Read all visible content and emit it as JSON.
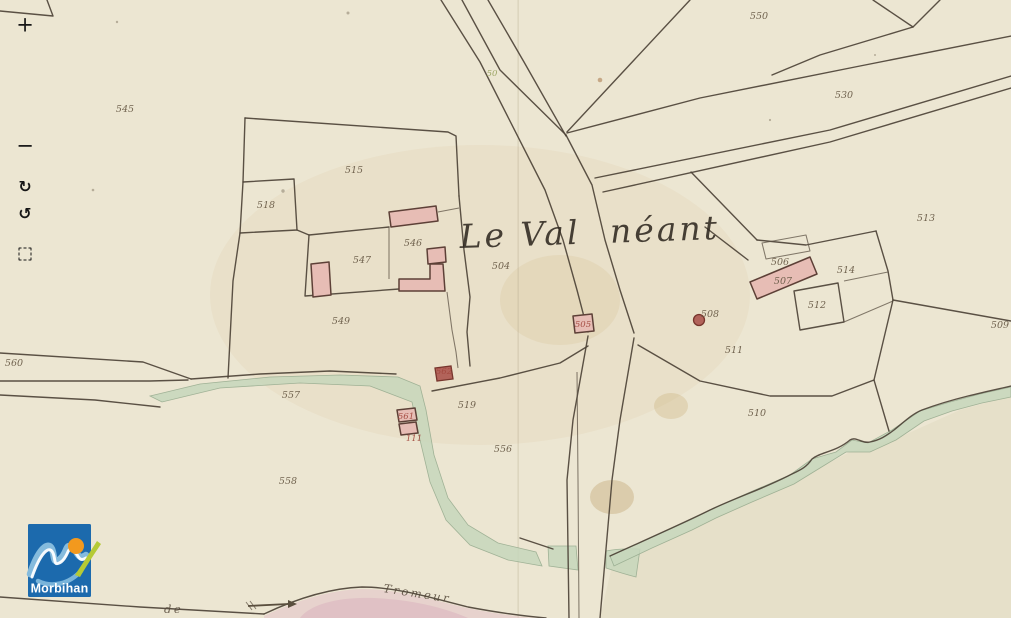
{
  "viewer": {
    "toolbar": {
      "zoom_in": "+",
      "zoom_out": "−",
      "rotate_cw": "↻",
      "rotate_ccw": "↺"
    },
    "logo": {
      "text": "Morbihan"
    }
  },
  "map": {
    "title": {
      "part1": "Le Val",
      "part2": "néant"
    },
    "bottom_text": {
      "de": "de",
      "tromeur": "Tromeur"
    },
    "parcel_labels": [
      {
        "n": "545",
        "x": 125,
        "y": 112
      },
      {
        "n": "515",
        "x": 354,
        "y": 173
      },
      {
        "n": "518",
        "x": 266,
        "y": 208
      },
      {
        "n": "546",
        "x": 413,
        "y": 246
      },
      {
        "n": "547",
        "x": 362,
        "y": 263
      },
      {
        "n": "549",
        "x": 341,
        "y": 324
      },
      {
        "n": "504",
        "x": 501,
        "y": 269
      },
      {
        "n": "50",
        "x": 492,
        "y": 76,
        "color": "green"
      },
      {
        "n": "550",
        "x": 759,
        "y": 19
      },
      {
        "n": "530",
        "x": 844,
        "y": 98
      },
      {
        "n": "513",
        "x": 926,
        "y": 221
      },
      {
        "n": "506",
        "x": 780,
        "y": 265
      },
      {
        "n": "507",
        "x": 783,
        "y": 284
      },
      {
        "n": "514",
        "x": 846,
        "y": 273
      },
      {
        "n": "512",
        "x": 817,
        "y": 308
      },
      {
        "n": "508",
        "x": 710,
        "y": 317
      },
      {
        "n": "511",
        "x": 734,
        "y": 353
      },
      {
        "n": "509",
        "x": 1000,
        "y": 328
      },
      {
        "n": "510",
        "x": 757,
        "y": 416
      },
      {
        "n": "505",
        "x": 583,
        "y": 327,
        "color": "red"
      },
      {
        "n": "562",
        "x": 444,
        "y": 374,
        "color": "red"
      },
      {
        "n": "561",
        "x": 406,
        "y": 419,
        "color": "red"
      },
      {
        "n": "111",
        "x": 414,
        "y": 441,
        "color": "red"
      },
      {
        "n": "519",
        "x": 467,
        "y": 408
      },
      {
        "n": "556",
        "x": 503,
        "y": 452
      },
      {
        "n": "557",
        "x": 291,
        "y": 398
      },
      {
        "n": "558",
        "x": 288,
        "y": 484
      },
      {
        "n": "560",
        "x": 14,
        "y": 366
      }
    ],
    "colors": {
      "paper": "#ece6d2",
      "ink": "#4d4337",
      "building_pink": "#e7bdb5",
      "building_red": "#b2635a",
      "water_green": "#c7d7bc",
      "logo_blue": "#1c6aad",
      "logo_orange": "#f2991e",
      "logo_green": "#b5ca35"
    }
  }
}
